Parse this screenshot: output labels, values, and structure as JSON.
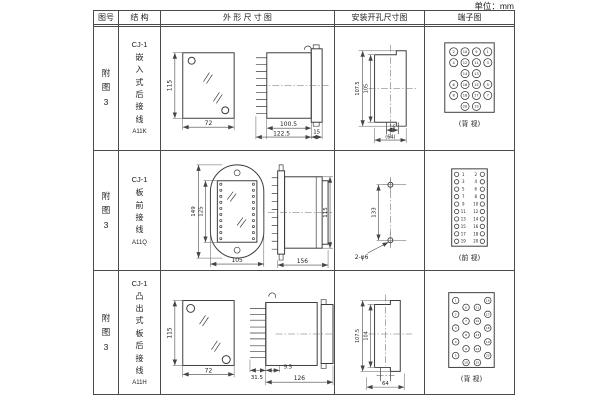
{
  "unit_label": "单位：mm",
  "header": {
    "fig": "图号",
    "structure": "结 构",
    "outline": "外 形 尺 寸 图",
    "mounting": "安装开孔尺寸图",
    "terminal": "端子图"
  },
  "rows": [
    {
      "fig": "附图3",
      "model": "CJ-1",
      "name": "嵌入式后接线",
      "code": "A11K",
      "outline": {
        "height": "115",
        "width": "72",
        "body_len": "100.5",
        "total_len": "122.5",
        "flange": "15"
      },
      "mounting": {
        "outer": "107.5",
        "inner": "105",
        "slot": "16",
        "span": "(64)"
      },
      "terminal": {
        "caption": "(背 视)",
        "pin_rows": [
          [
            "2",
            "10",
            "9",
            "1"
          ],
          [
            "4",
            "12",
            "11",
            "3"
          ],
          [
            "14",
            "13"
          ],
          [
            "6",
            "16",
            "15",
            "5"
          ],
          [
            "8",
            "18",
            "17",
            "7"
          ],
          [
            "20",
            "19"
          ]
        ]
      }
    },
    {
      "fig": "附图3",
      "model": "CJ-1",
      "name": "板前接线",
      "code": "A11Q",
      "outline": {
        "outer_h": "149",
        "inner_h": "125",
        "width": "105",
        "depth": "156",
        "body_h": "115"
      },
      "mounting": {
        "spacing": "133",
        "holes": "2-φ6"
      },
      "terminal": {
        "caption": "(前 视)",
        "left": [
          "1",
          "3",
          "5",
          "7",
          "9",
          "11",
          "13",
          "15",
          "17",
          "19"
        ],
        "right": [
          "2",
          "4",
          "6",
          "8",
          "10",
          "12",
          "14",
          "16",
          "18",
          "20"
        ]
      }
    },
    {
      "fig": "附图3",
      "model": "CJ-1",
      "name": "凸出式板后接线",
      "code": "A11H",
      "outline": {
        "height": "115",
        "width": "72",
        "comb": "31.5",
        "offset": "9.5",
        "total_len": "126"
      },
      "mounting": {
        "outer": "107.5",
        "inner": "104",
        "span": "64"
      },
      "terminal": {
        "caption": "(背 视)",
        "cols": [
          [
            "1",
            "2",
            "3",
            "4",
            "5"
          ],
          [
            "6",
            "7",
            "8",
            "9",
            "10"
          ],
          [
            "11",
            "12",
            "13",
            "14",
            "15"
          ],
          [
            "16",
            "17",
            "18",
            "19",
            "20"
          ]
        ]
      }
    }
  ]
}
